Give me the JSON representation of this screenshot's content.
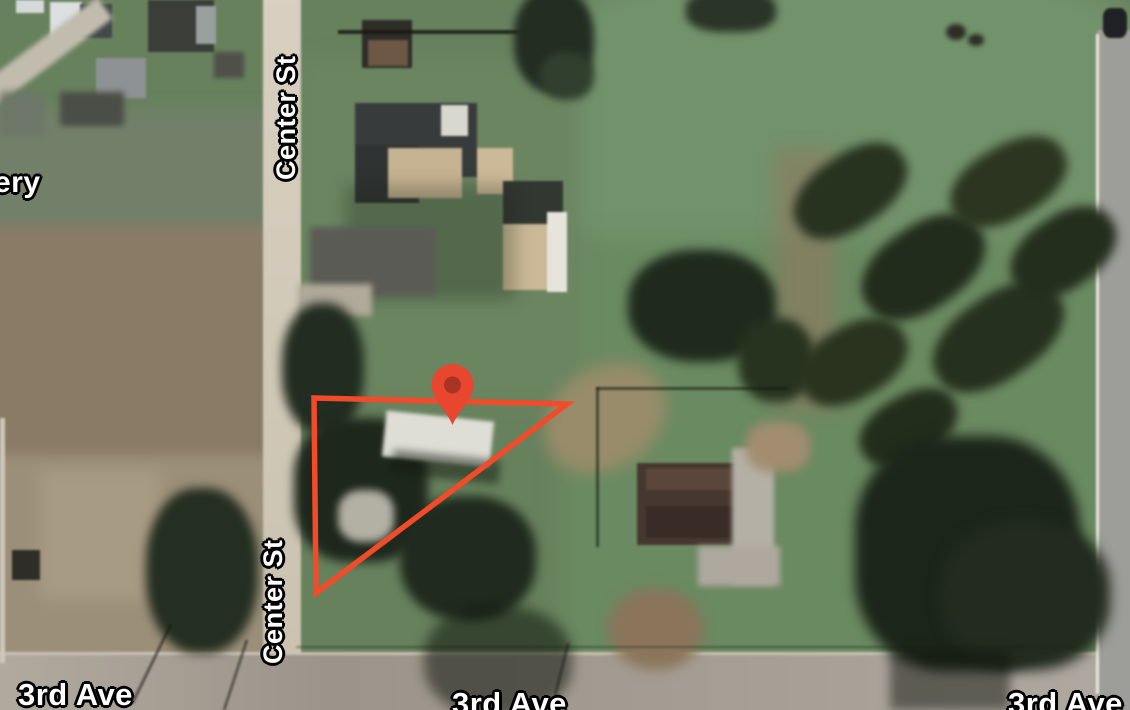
{
  "map": {
    "view": "satellite",
    "labels": {
      "center_st": "Center St",
      "third_ave": "3rd Ave",
      "partial_left": "ery"
    },
    "marker": {
      "name": "red-location-pin",
      "transform": "translate(452.5,425)",
      "body_color": "#e8462e",
      "inner_color": "#a83426"
    },
    "parcel": {
      "shape": "triangle",
      "points": "314,398 567,404 316,593",
      "stroke": "#f14b2a",
      "stroke_width": "5.5"
    },
    "colors": {
      "accent_red": "#f14b2a",
      "grass": "#67815d",
      "road": "#cfc7b3"
    }
  }
}
